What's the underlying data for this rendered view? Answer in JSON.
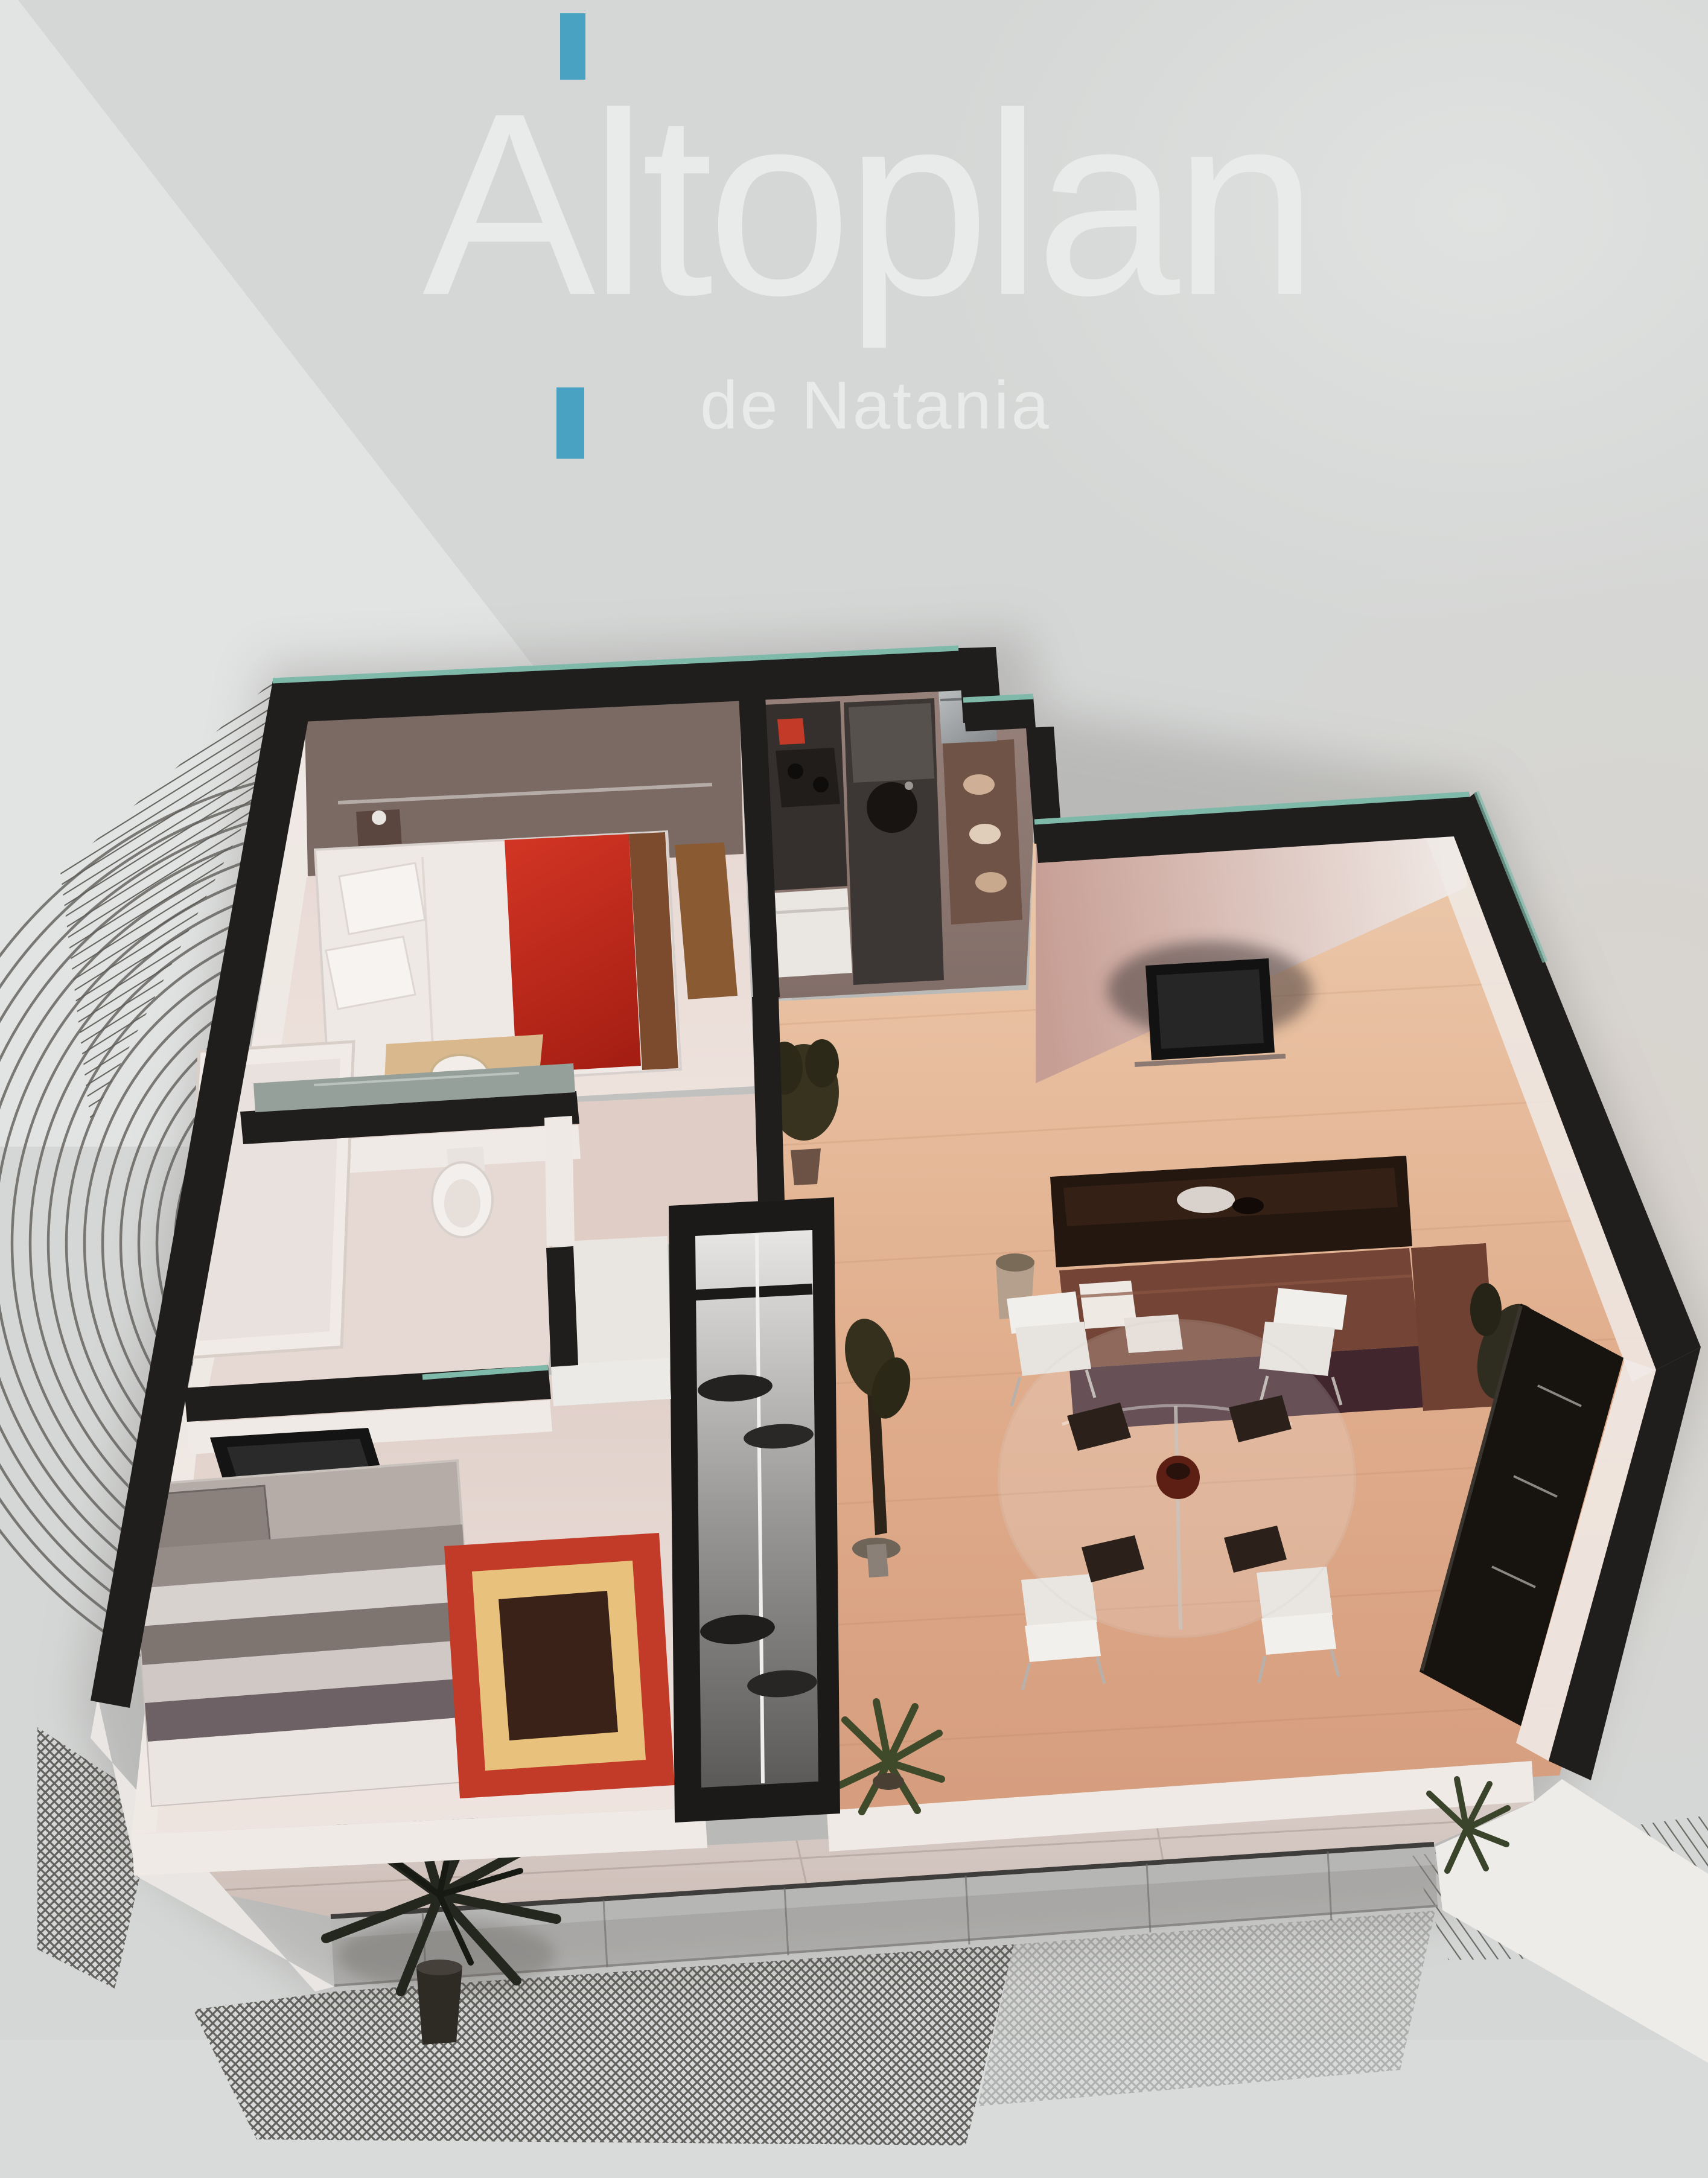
{
  "brand": {
    "wordmark": "Altoplan",
    "subtitle": "de Natania"
  },
  "palette": {
    "page-bg": "#d5d7d6",
    "page-bg-light": "#e4e6e5",
    "accent-blue": "#4aa2c2",
    "logo-text": "#e9ebeb",
    "wall-black": "#201e1c",
    "wall-edge-teal": "#7fb9a9",
    "wood-floor-light": "#ecc9ab",
    "wood-floor-dark": "#d59d7e",
    "pale-floor": "#ecdfda",
    "kitchen-floor": "#8d7770",
    "bed-red": "#c5271d",
    "sofa-brown": "#6e4132",
    "sofa-back": "#42262e",
    "rug-red": "#c23b28",
    "rug-gold": "#e8c27c",
    "rug-center": "#3a2218",
    "hatch-line": "#54524e",
    "white-face": "#efeae6"
  },
  "floor_plan": {
    "view": "3d-isometric-apartment-render-from-above",
    "rooms": [
      {
        "name": "master-bedroom",
        "position": "top-left",
        "furniture": [
          "double-bed-red-cover",
          "dark-dresser",
          "nightstand-lamp",
          "wood-desk"
        ]
      },
      {
        "name": "kitchen",
        "position": "top-center",
        "furniture": [
          "dark-counter-stove-red-pot",
          "island-with-sink",
          "white-appliance",
          "fridge",
          "bar-counter"
        ]
      },
      {
        "name": "living-room",
        "position": "right",
        "furniture": [
          "wall-tv",
          "coffee-table",
          "brown-l-sofa-white-pillows",
          "vase",
          "corner-plant"
        ]
      },
      {
        "name": "dining-area",
        "position": "center-right",
        "furniture": [
          "round-glass-table",
          "four-white-chairs",
          "four-dark-placemats",
          "dark-sideboard",
          "sculpture-plant"
        ]
      },
      {
        "name": "bathroom",
        "position": "mid-left",
        "furniture": [
          "bathtub",
          "sink-counter",
          "toilet"
        ]
      },
      {
        "name": "second-bedroom",
        "position": "bottom-left",
        "furniture": [
          "single-bed-striped",
          "corner-tv",
          "red-framed-rug",
          "open-closet"
        ]
      },
      {
        "name": "hallway",
        "position": "center",
        "furniture": [
          "potted-plant"
        ]
      },
      {
        "name": "balcony",
        "position": "bottom",
        "furniture": [
          "glass-railing",
          "palm-plant",
          "agave-plants"
        ]
      }
    ],
    "shadow_decorations": [
      "diagonal-hatch-top-left",
      "concentric-arcs-left",
      "crosshatch-bottom",
      "diagonal-hatch-bottom-right"
    ]
  }
}
